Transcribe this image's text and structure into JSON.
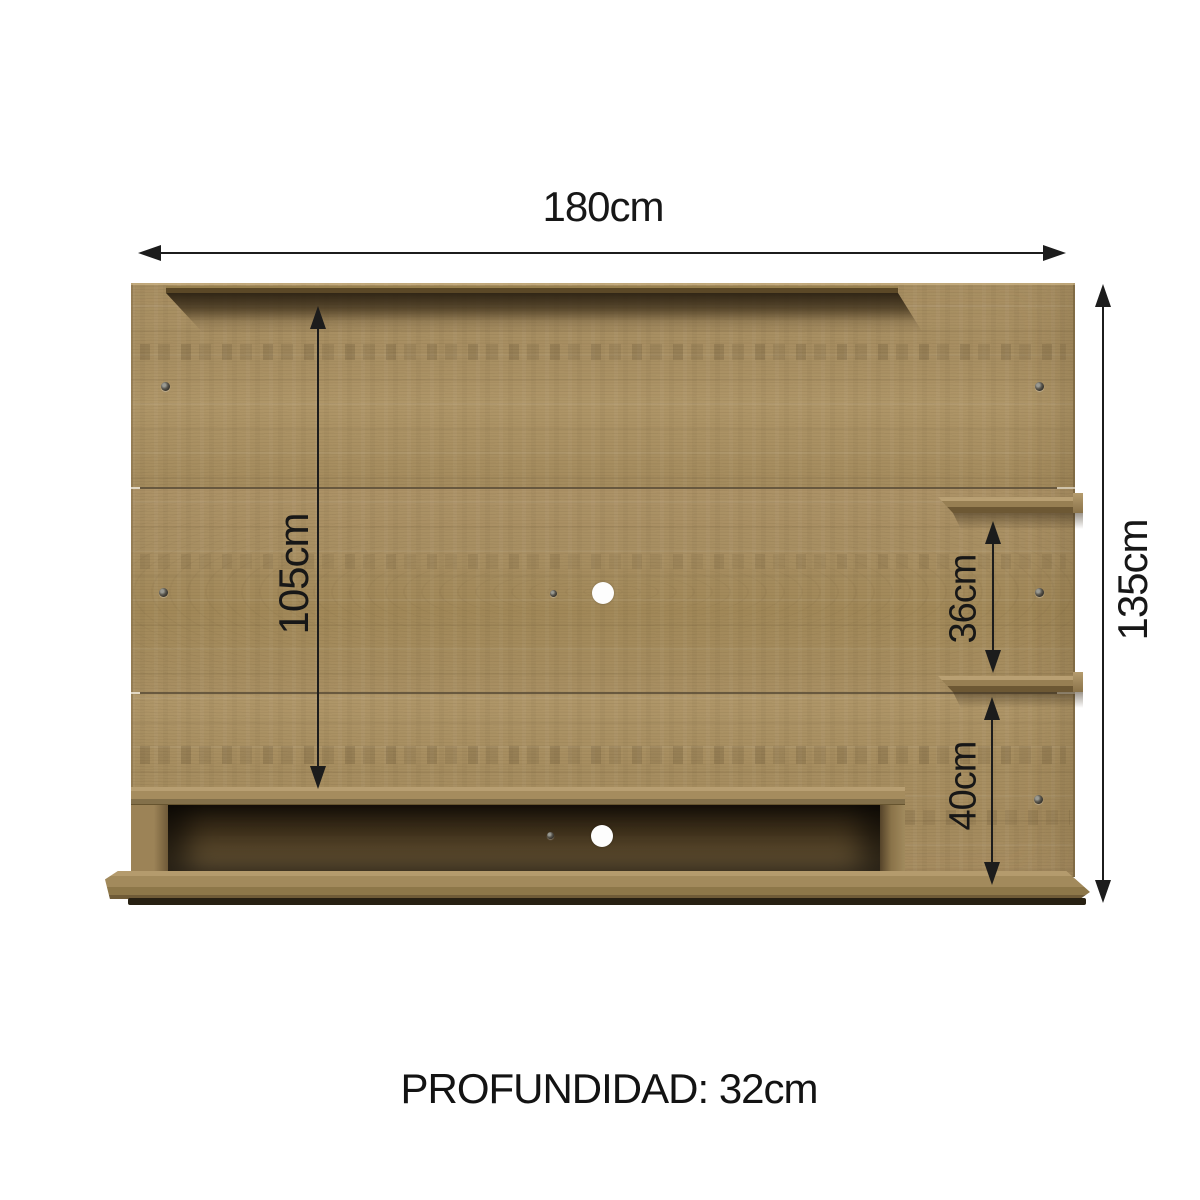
{
  "diagram": {
    "kind": "tv-wall-panel-dimension-diagram",
    "dimensions": {
      "width": {
        "label": "180cm"
      },
      "height": {
        "label": "135cm"
      },
      "tv_area_height": {
        "label": "105cm"
      },
      "shelf_gap": {
        "label": "36cm"
      },
      "bottom_section": {
        "label": "40cm"
      },
      "depth": {
        "label": "PROFUNDIDAD: 32cm"
      }
    },
    "colors": {
      "background": "#ffffff",
      "wood_base": "#a58c5f",
      "wood_light": "#b49b6d",
      "wood_dark": "#6e5936",
      "shadow_dark": "#2e2414",
      "dimension_line": "#1c1c1c",
      "text": "#171717"
    }
  }
}
